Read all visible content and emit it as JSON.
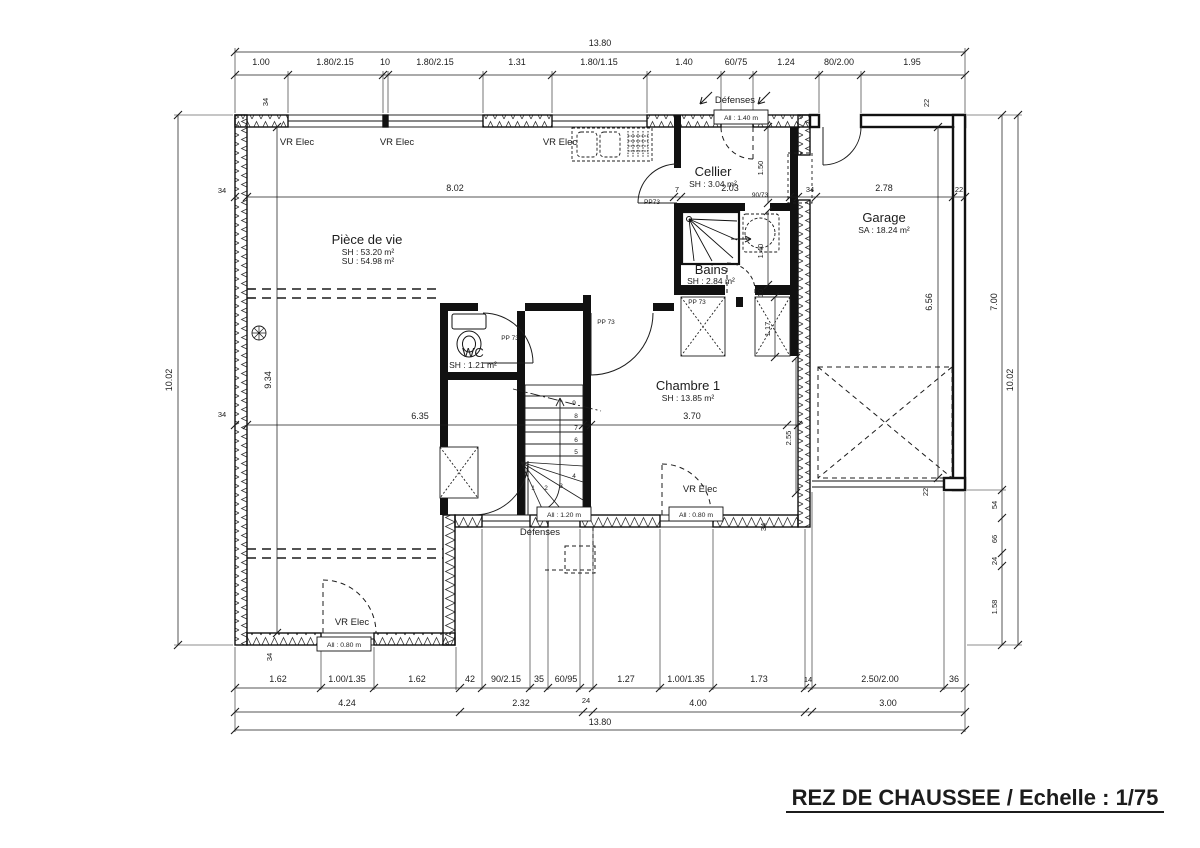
{
  "title": "REZ DE CHAUSSEE / Echelle : 1/75",
  "dims": {
    "overall_w": "13.80",
    "overall_h": "10.02",
    "top": [
      "1.00",
      "1.80/2.15",
      "10",
      "1.80/2.15",
      "1.31",
      "1.80/1.15",
      "1.40",
      "60/75",
      "1.24",
      "80/2.00",
      "1.95"
    ],
    "bottom1": [
      "1.62",
      "1.00/1.35",
      "1.62",
      "42",
      "90/2.15",
      "35",
      "60/95",
      "24",
      "1.27",
      "1.00/1.35",
      "1.73",
      "14",
      "2.50/2.00",
      "36"
    ],
    "bottom2": [
      "4.24",
      "2.32",
      "4.00",
      "3.00"
    ],
    "bottom_overall": "13.80",
    "left_interior": "9.34",
    "living_w": "8.02",
    "living_w2": "6.35",
    "pier7": "7",
    "cellier_w": "2.03",
    "cellier_d": "1.50",
    "bains_d": "1.40",
    "wall10": "10",
    "placard_d": "1.17",
    "chambre_side": "2.55",
    "chambre_w": "3.70",
    "garage_w": "2.78",
    "garage_h_in": "6.56",
    "garage_h_out": "7.00",
    "wall34": "34",
    "wall22": "22",
    "wall24": "24",
    "seg54": "54",
    "seg66": "66",
    "seg158": "1.58"
  },
  "rooms": {
    "living": {
      "name": "Pièce de vie",
      "sh": "SH : 53.20 m²",
      "su": "SU : 54.98 m²"
    },
    "cellier": {
      "name": "Cellier",
      "sh": "SH : 3.04 m²"
    },
    "bains": {
      "name": "Bains",
      "sh": "SH : 2.84 m²"
    },
    "wc": {
      "name": "WC",
      "sh": "SH : 1.21 m²"
    },
    "chambre": {
      "name": "Chambre 1",
      "sh": "SH : 13.85 m²"
    },
    "garage": {
      "name": "Garage",
      "sa": "SA : 18.24 m²"
    }
  },
  "labels": {
    "vr_elec": "VR Elec",
    "defenses": "Défenses",
    "all_140": "All : 1.40 m",
    "all_120": "All : 1.20 m",
    "all_080": "All : 0.80 m",
    "pp73": "PP73",
    "pp_73": "PP 73",
    "door_9073": "90/73"
  },
  "stairs": {
    "numbers": [
      "1",
      "2",
      "3",
      "4",
      "5",
      "6",
      "7",
      "8",
      "9"
    ]
  },
  "colors": {
    "ink": "#1c1c1c",
    "paper": "#ffffff"
  }
}
